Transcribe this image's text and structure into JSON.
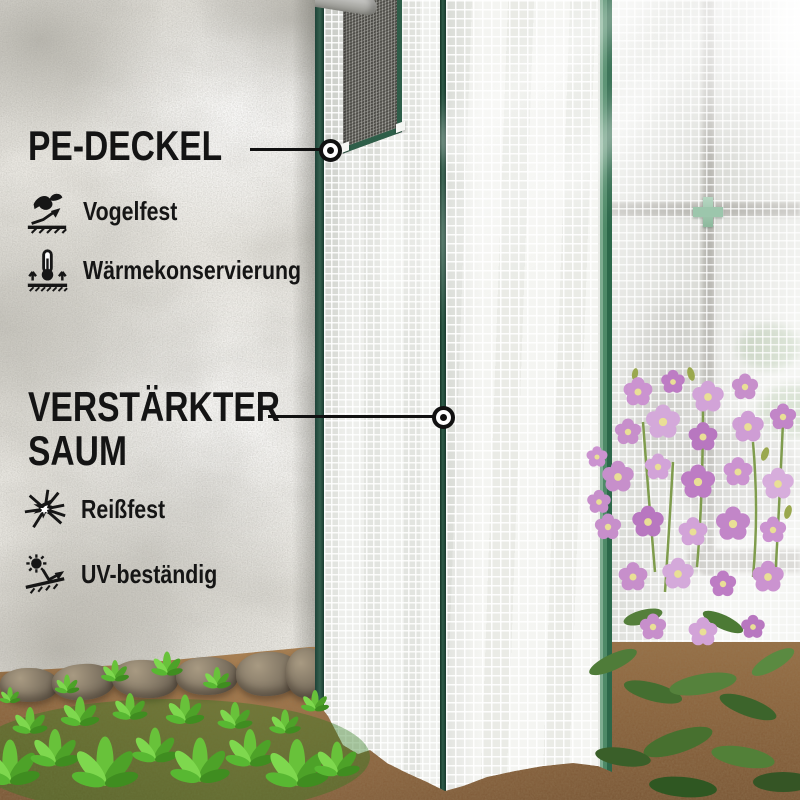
{
  "annotations": {
    "callout_top": {
      "title": "PE-DECKEL"
    },
    "callout_mid": {
      "title_lines": [
        "VERSTÄRKTER",
        "SAUM"
      ]
    },
    "features_top": [
      {
        "icon": "bird-proof-icon",
        "label": "Vogelfest"
      },
      {
        "icon": "heat-conservation-icon",
        "label": "Wärmekonservierung"
      }
    ],
    "features_bottom": [
      {
        "icon": "tear-resistant-icon",
        "label": "Reißfest"
      },
      {
        "icon": "uv-resistant-icon",
        "label": "UV-beständig"
      }
    ]
  },
  "colors": {
    "text": "#141414",
    "callout": "#111111",
    "trim_green": "#2c5c48",
    "binding_green": "#4e8a68",
    "cross_teal": "#9cc6ac",
    "flower_pink": "#c78fcb",
    "seedling_green": "#5cb32f",
    "soil_brown": "#a0754a",
    "wall_gray": "#e9e7e1",
    "cover_white": "#f2f3ef"
  }
}
